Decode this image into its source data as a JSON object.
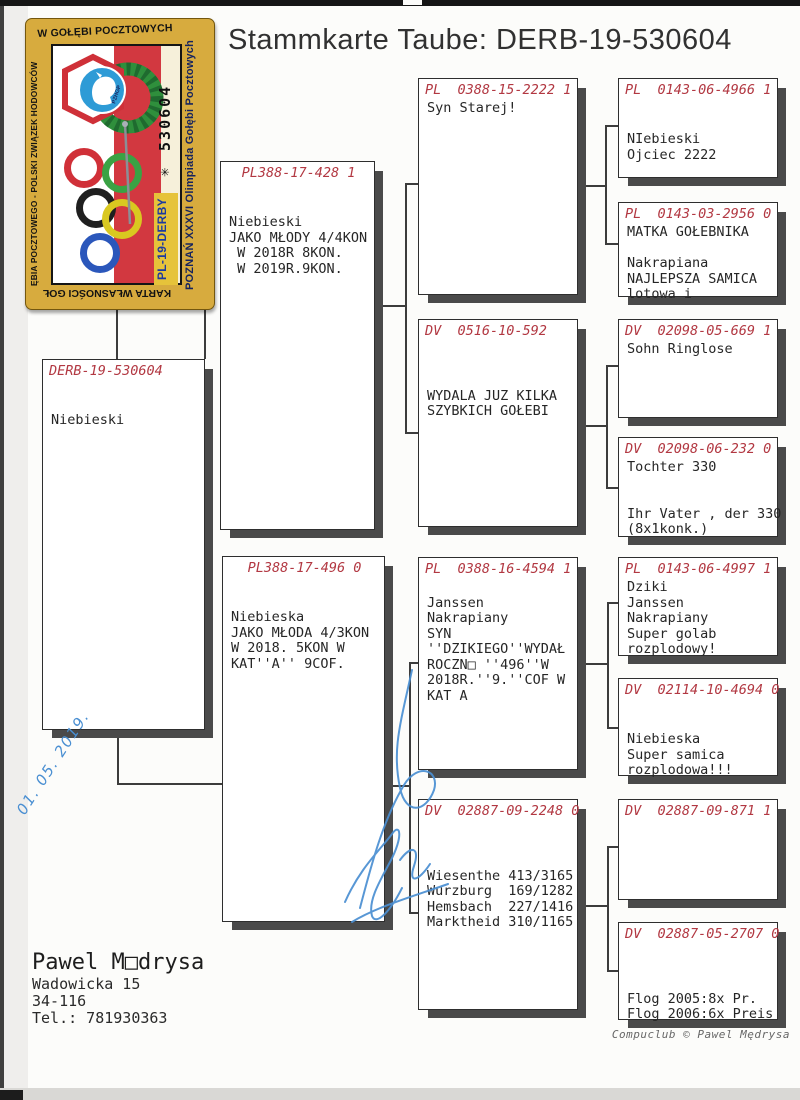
{
  "page": {
    "title": "Stammkarte Taube: DERB-19-530604"
  },
  "colors": {
    "header_red": "#b23842",
    "box_shadow": "#4a4a4a",
    "tree_line": "#3c3c3c",
    "ink_blue": "#4a8fd2",
    "stamp_gold": "#d7ab3e",
    "stamp_navy": "#15235e"
  },
  "stamp": {
    "top_text": "W GOŁĘBI POCZTOWYCH",
    "left_text": "ĘBIA POCZTOWEGO - POLSKI ZWIĄZEK HODOWCÓW",
    "bottom_text": "KARTA WŁASNOŚCI GOŁ",
    "right_text": "POZNAŃ XXXVI Olimpiada Gołębi Pocztowych",
    "serial": "✳ 530604",
    "derby_code": "PL-19-DERBY",
    "badge_text": "PZHGP"
  },
  "pedigree": {
    "boxes": [
      {
        "id": "subject",
        "x": 42,
        "y": 359,
        "w": 163,
        "h": 371,
        "align": "left",
        "header": "DERB-19-530604",
        "lines": [
          "",
          "",
          "Niebieski"
        ]
      },
      {
        "id": "father",
        "x": 220,
        "y": 161,
        "w": 155,
        "h": 369,
        "align": "center",
        "header": "PL388-17-428 1",
        "lines": [
          "",
          "",
          "Niebieski",
          "JAKO MŁODY 4/4KON",
          " W 2018R 8KON.",
          " W 2019R.9KON."
        ]
      },
      {
        "id": "mother",
        "x": 222,
        "y": 556,
        "w": 163,
        "h": 366,
        "align": "center",
        "header": "PL388-17-496 0",
        "lines": [
          "",
          "",
          "Niebieska",
          "JAKO MŁODA 4/3KON",
          "W 2018. 5KON W",
          "KAT''A'' 9COF."
        ]
      },
      {
        "id": "ff",
        "x": 418,
        "y": 78,
        "w": 160,
        "h": 217,
        "align": "left",
        "header": "PL  0388-15-2222 1",
        "lines": [
          "Syn Starej!"
        ]
      },
      {
        "id": "fm",
        "x": 418,
        "y": 319,
        "w": 160,
        "h": 208,
        "align": "left",
        "header": "DV  0516-10-592",
        "lines": [
          "",
          "",
          "",
          "WYDALA JUZ KILKA",
          "SZYBKICH GOŁEBI"
        ]
      },
      {
        "id": "mf",
        "x": 418,
        "y": 557,
        "w": 160,
        "h": 213,
        "align": "left",
        "header": "PL  0388-16-4594 1",
        "lines": [
          "",
          "Janssen",
          "Nakrapiany",
          "SYN",
          "''DZIKIEGO''WYDAŁ",
          "ROCZN□ ''496''W",
          "2018R.''9.''COF W",
          "KAT A"
        ]
      },
      {
        "id": "mm",
        "x": 418,
        "y": 799,
        "w": 160,
        "h": 211,
        "align": "left",
        "header": "DV  02887-09-2248 0",
        "lines": [
          "",
          "",
          "",
          "Wiesenthe 413/3165",
          "Wurzburg  169/1282",
          "Hemsbach  227/1416",
          "Marktheid 310/1165"
        ]
      },
      {
        "id": "fff",
        "x": 618,
        "y": 78,
        "w": 160,
        "h": 100,
        "align": "left",
        "header": "PL  0143-06-4966 1",
        "lines": [
          "",
          "",
          "NIebieski",
          "Ojciec 2222"
        ]
      },
      {
        "id": "ffm",
        "x": 618,
        "y": 202,
        "w": 160,
        "h": 95,
        "align": "left",
        "header": "PL  0143-03-2956 0",
        "lines": [
          "MATKA GOŁEBNIKA",
          "",
          "Nakrapiana",
          "NAJLEPSZA SAMICA",
          "lotowa i"
        ]
      },
      {
        "id": "fmf",
        "x": 618,
        "y": 319,
        "w": 160,
        "h": 99,
        "align": "left",
        "header": "DV  02098-05-669 1",
        "lines": [
          "Sohn Ringlose"
        ]
      },
      {
        "id": "fmm",
        "x": 618,
        "y": 437,
        "w": 160,
        "h": 100,
        "align": "left",
        "header": "DV  02098-06-232 0",
        "lines": [
          "Tochter 330",
          "",
          "",
          "Ihr Vater , der 330",
          "(8x1konk.)"
        ]
      },
      {
        "id": "mff",
        "x": 618,
        "y": 557,
        "w": 160,
        "h": 99,
        "align": "left",
        "header": "PL  0143-06-4997 1",
        "lines": [
          "Dziki",
          "Janssen",
          "Nakrapiany",
          "Super golab",
          "rozplodowy!"
        ]
      },
      {
        "id": "mfm",
        "x": 618,
        "y": 678,
        "w": 160,
        "h": 98,
        "align": "left",
        "header": "DV  02114-10-4694 0",
        "lines": [
          "",
          "",
          "Niebieska",
          "Super samica",
          "rozplodowa!!!"
        ]
      },
      {
        "id": "mmf",
        "x": 618,
        "y": 799,
        "w": 160,
        "h": 101,
        "align": "left",
        "header": "DV  02887-09-871 1",
        "lines": []
      },
      {
        "id": "mmm",
        "x": 618,
        "y": 922,
        "w": 160,
        "h": 98,
        "align": "left",
        "header": "DV  02887-05-2707 0",
        "lines": [
          "",
          "",
          "",
          "Flog 2005:8x Pr.",
          "Flog 2006:6x Preis"
        ]
      }
    ]
  },
  "tree_segments": [
    {
      "x": 116,
      "y": 305,
      "w": 1,
      "h": 54
    },
    {
      "x": 116,
      "y": 305,
      "w": 89,
      "h": 1
    },
    {
      "x": 204,
      "y": 305,
      "w": 1,
      "h": 54
    },
    {
      "x": 117,
      "y": 730,
      "w": 1,
      "h": 53
    },
    {
      "x": 117,
      "y": 783,
      "w": 106,
      "h": 1
    },
    {
      "x": 375,
      "y": 305,
      "w": 31,
      "h": 1
    },
    {
      "x": 405,
      "y": 183,
      "w": 1,
      "h": 250
    },
    {
      "x": 405,
      "y": 183,
      "w": 14,
      "h": 1
    },
    {
      "x": 405,
      "y": 432,
      "w": 14,
      "h": 1
    },
    {
      "x": 387,
      "y": 785,
      "w": 23,
      "h": 1
    },
    {
      "x": 409,
      "y": 662,
      "w": 1,
      "h": 251
    },
    {
      "x": 409,
      "y": 662,
      "w": 13,
      "h": 1
    },
    {
      "x": 409,
      "y": 912,
      "w": 13,
      "h": 1
    },
    {
      "x": 578,
      "y": 185,
      "w": 28,
      "h": 1
    },
    {
      "x": 605,
      "y": 125,
      "w": 1,
      "h": 119
    },
    {
      "x": 605,
      "y": 125,
      "w": 14,
      "h": 1
    },
    {
      "x": 605,
      "y": 243,
      "w": 14,
      "h": 1
    },
    {
      "x": 578,
      "y": 425,
      "w": 29,
      "h": 1
    },
    {
      "x": 606,
      "y": 365,
      "w": 1,
      "h": 123
    },
    {
      "x": 606,
      "y": 365,
      "w": 13,
      "h": 1
    },
    {
      "x": 606,
      "y": 487,
      "w": 13,
      "h": 1
    },
    {
      "x": 578,
      "y": 663,
      "w": 30,
      "h": 1
    },
    {
      "x": 607,
      "y": 602,
      "w": 1,
      "h": 126
    },
    {
      "x": 607,
      "y": 602,
      "w": 12,
      "h": 1
    },
    {
      "x": 607,
      "y": 727,
      "w": 12,
      "h": 1
    },
    {
      "x": 578,
      "y": 905,
      "w": 30,
      "h": 1
    },
    {
      "x": 607,
      "y": 846,
      "w": 1,
      "h": 125
    },
    {
      "x": 607,
      "y": 846,
      "w": 12,
      "h": 1
    },
    {
      "x": 607,
      "y": 970,
      "w": 12,
      "h": 1
    }
  ],
  "handwriting": {
    "date": "01. 05. 2019."
  },
  "owner": {
    "name": "Pawel M□drysa",
    "address1": "Wadowicka 15",
    "address2": "34-116",
    "phone": "Tel.: 781930363"
  },
  "footer": {
    "credit": "Compuclub © Pawel Mędrysa"
  }
}
